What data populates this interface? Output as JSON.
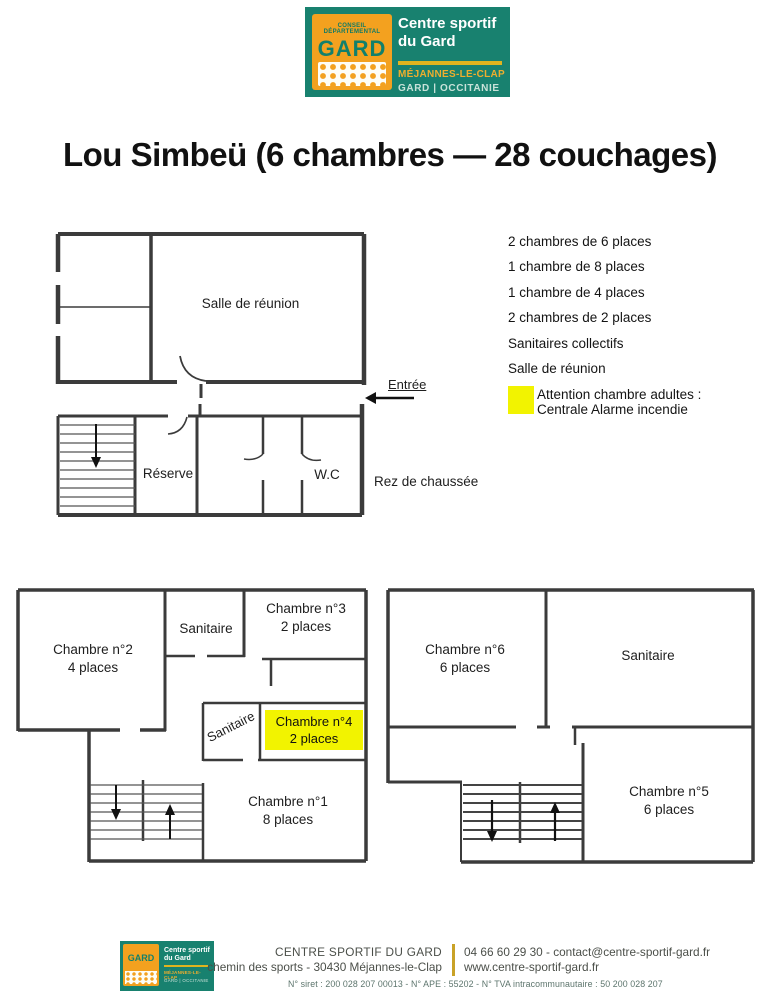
{
  "brand": {
    "conseil": "CONSEIL DÉPARTEMENTAL",
    "gard": "GARD",
    "name1": "Centre sportif",
    "name2": "du Gard",
    "location": "MÉJANNES-LE-CLAP",
    "region": "GARD | OCCITANIE"
  },
  "title": "Lou Simbeü (6 chambres — 28 couchages)",
  "summary": {
    "items": [
      "2 chambres de 6 places",
      "1 chambre de 8 places",
      "1 chambre de 4 places",
      "2 chambres de 2 places",
      "Sanitaires collectifs",
      "Salle de réunion"
    ],
    "warning1": "Attention chambre adultes :",
    "warning2": "Centrale Alarme incendie"
  },
  "ground_floor": {
    "meeting_room": "Salle de réunion",
    "entrance": "Entrée",
    "reserve": "Réserve",
    "wc": "W.C",
    "label": "Rez de chaussée"
  },
  "first_floor": {
    "room2_name": "Chambre n°2",
    "room2_cap": "4 places",
    "sanitaire_top": "Sanitaire",
    "room3_name": "Chambre n°3",
    "room3_cap": "2 places",
    "sanitaire_mid": "Sanitaire",
    "room4_name": "Chambre n°4",
    "room4_cap": "2 places",
    "room1_name": "Chambre n°1",
    "room1_cap": "8 places"
  },
  "second_floor": {
    "room6_name": "Chambre n°6",
    "room6_cap": "6 places",
    "sanitaire": "Sanitaire",
    "room5_name": "Chambre n°5",
    "room5_cap": "6 places"
  },
  "footer": {
    "org": "CENTRE SPORTIF DU GARD",
    "address": "chemin des sports - 30430 Méjannes-le-Clap",
    "phone_email": "04 66 60 29 30 - contact@centre-sportif-gard.fr",
    "website": "www.centre-sportif-gard.fr",
    "legal": "N° siret : 200 028 207 00013 - N° APE : 55202 - N° TVA intracommunautaire : 50 200 028 207"
  },
  "colors": {
    "teal": "#18816f",
    "orange": "#f3a11f",
    "brand_yellow": "#dfb41f",
    "highlight_yellow": "#f2f300"
  }
}
